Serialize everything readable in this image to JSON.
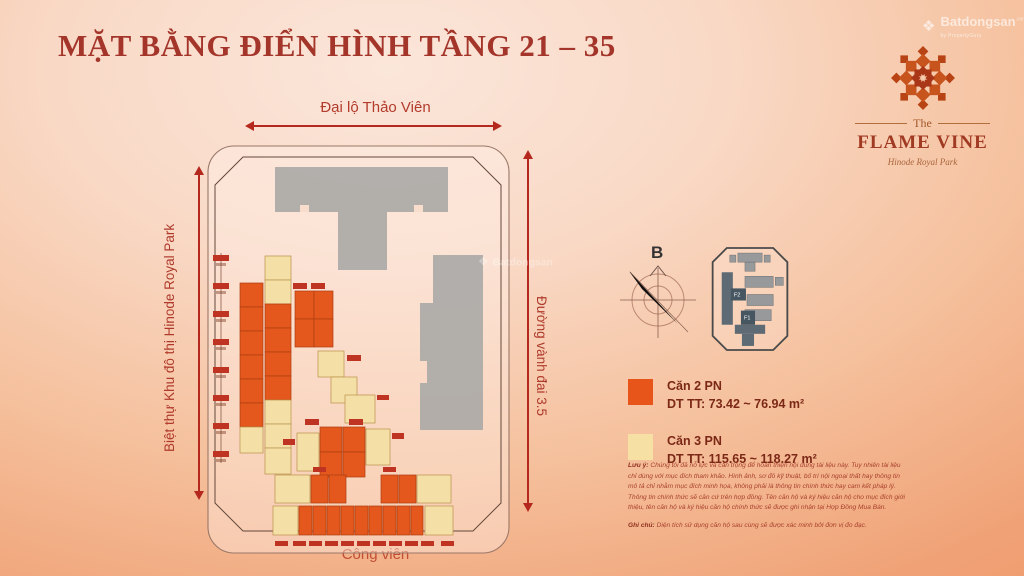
{
  "page": {
    "title": "MẶT BẰNG ĐIỂN HÌNH TẦNG 21 – 35"
  },
  "watermark": {
    "brand": "Batdongsan",
    "suffix": ".com.vn",
    "tagline": "by PropertyGuru"
  },
  "logo": {
    "the": "The",
    "name": "FLAME VINE",
    "subtitle": "Hinode Royal Park"
  },
  "plan": {
    "road_top": "Đại lộ Thảo Viên",
    "road_left": "Biệt thự Khu đô thị Hinode Royal Park",
    "road_right": "Đường vành đai 3.5",
    "road_bottom": "Công viên",
    "compass_label": "B",
    "minimap": {
      "f1": "F1",
      "f2": "F2"
    }
  },
  "legend": {
    "items": [
      {
        "label": "Căn 2 PN",
        "area": "DT TT: 73.42 ~ 76.94 m²",
        "color": "#e8551a"
      },
      {
        "label": "Căn 3 PN",
        "area": "DT TT: 115.65 ~ 118.27 m²",
        "color": "#f7e0a4"
      }
    ]
  },
  "notes": {
    "luu_y_label": "Lưu ý:",
    "luu_y": "Chúng tôi đã nỗ lực và cẩn trọng để hoàn thiện nội dung tài liệu này. Tuy nhiên tài liệu chỉ dùng với mục đích tham khảo. Hình ảnh, sơ đồ kỹ thuật, bố trí nội ngoại thất hay thông tin mô tả chỉ nhằm mục đích minh họa, không phải là thông tin chính thức hay cam kết pháp lý. Thông tin chính thức sẽ căn cứ trên hợp đồng. Tên căn hộ và ký hiệu căn hộ cho mục đích giới thiệu, tên căn hộ và ký hiệu căn hộ chính thức sẽ được ghi nhận tại Hợp Đồng Mua Bán.",
    "ghi_chu_label": "Ghi chú:",
    "ghi_chu": "Diện tích sử dụng căn hộ sau cùng sẽ được xác minh bởi đơn vị đo đạc."
  }
}
